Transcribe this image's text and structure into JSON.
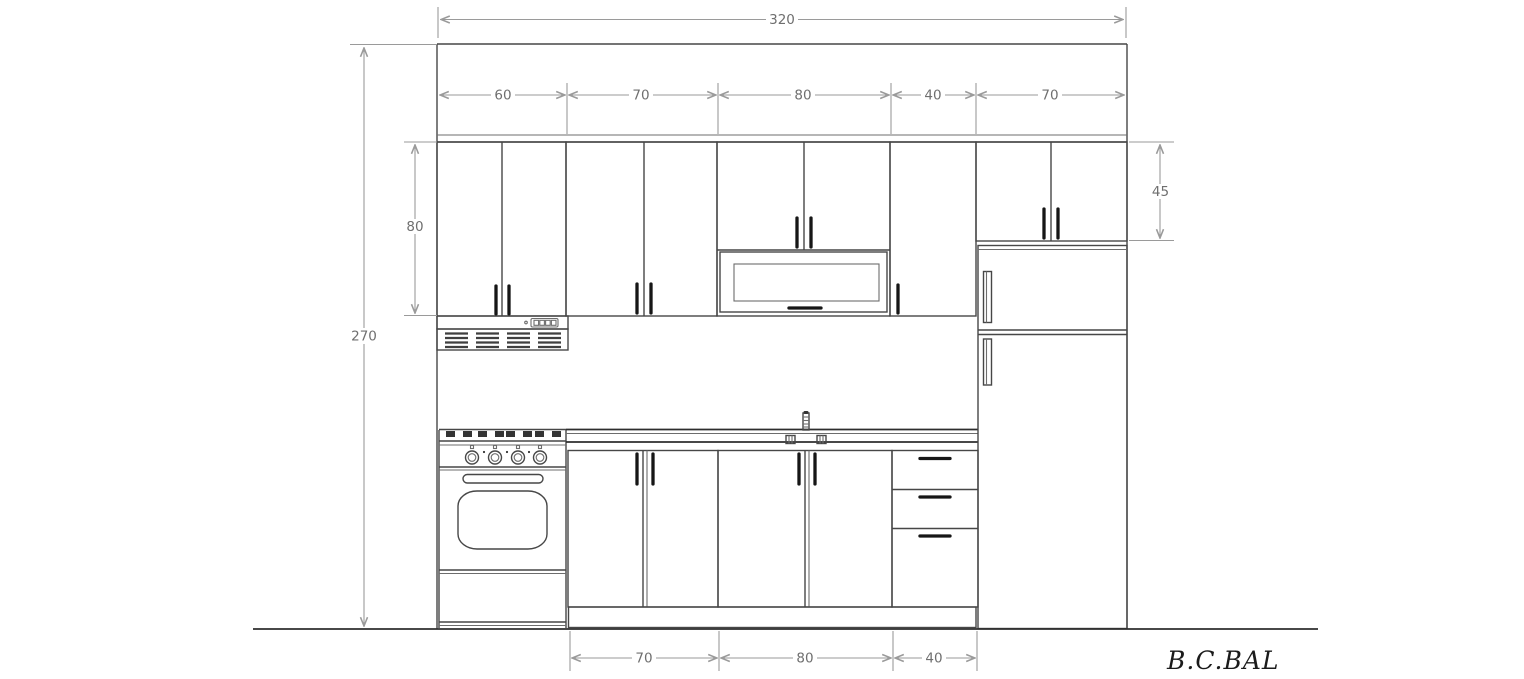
{
  "drawing": {
    "type": "kitchen-elevation-technical-drawing",
    "background": "#ffffff",
    "object_line_color": "#474747",
    "dimension_line_color": "#9a9a9a",
    "dimension_text_color": "#6f6f6f"
  },
  "dimensions": {
    "total_width": "320",
    "total_height": "270",
    "wall_cabinet_height": "80",
    "right_wall_cabinet_height": "45",
    "wall_cabinet_widths": [
      "60",
      "70",
      "80",
      "40",
      "70"
    ],
    "base_cabinet_widths": [
      "70",
      "80",
      "40"
    ]
  },
  "signature": "B.C.BAL"
}
